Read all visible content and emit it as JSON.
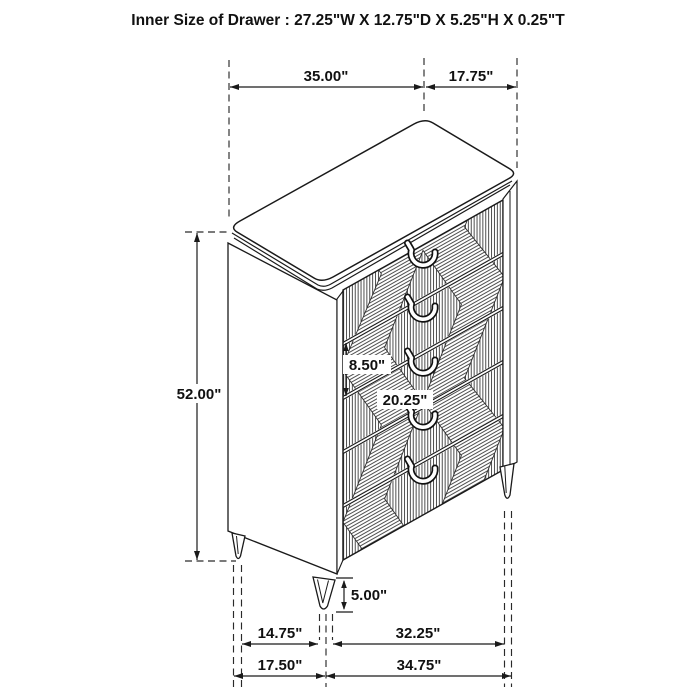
{
  "title": "Inner Size of Drawer : 27.25\"W X 12.75\"D X 5.25\"H X 0.25\"T",
  "diagram": {
    "type": "furniture-dimension-diagram",
    "subject": "5-drawer chest, isometric line drawing with diamond-pattern drawer fronts",
    "dimensions": {
      "top_width": "35.00\"",
      "top_depth": "17.75\"",
      "overall_height": "52.00\"",
      "drawer_front_height": "8.50\"",
      "drawer_width": "20.25\"",
      "leg_height": "5.00\"",
      "base_inner_left": "14.75\"",
      "base_inner_right": "32.25\"",
      "base_outer_left": "17.50\"",
      "base_outer_right": "34.75\""
    },
    "colors": {
      "line": "#1a1a1a",
      "background": "#ffffff"
    }
  }
}
